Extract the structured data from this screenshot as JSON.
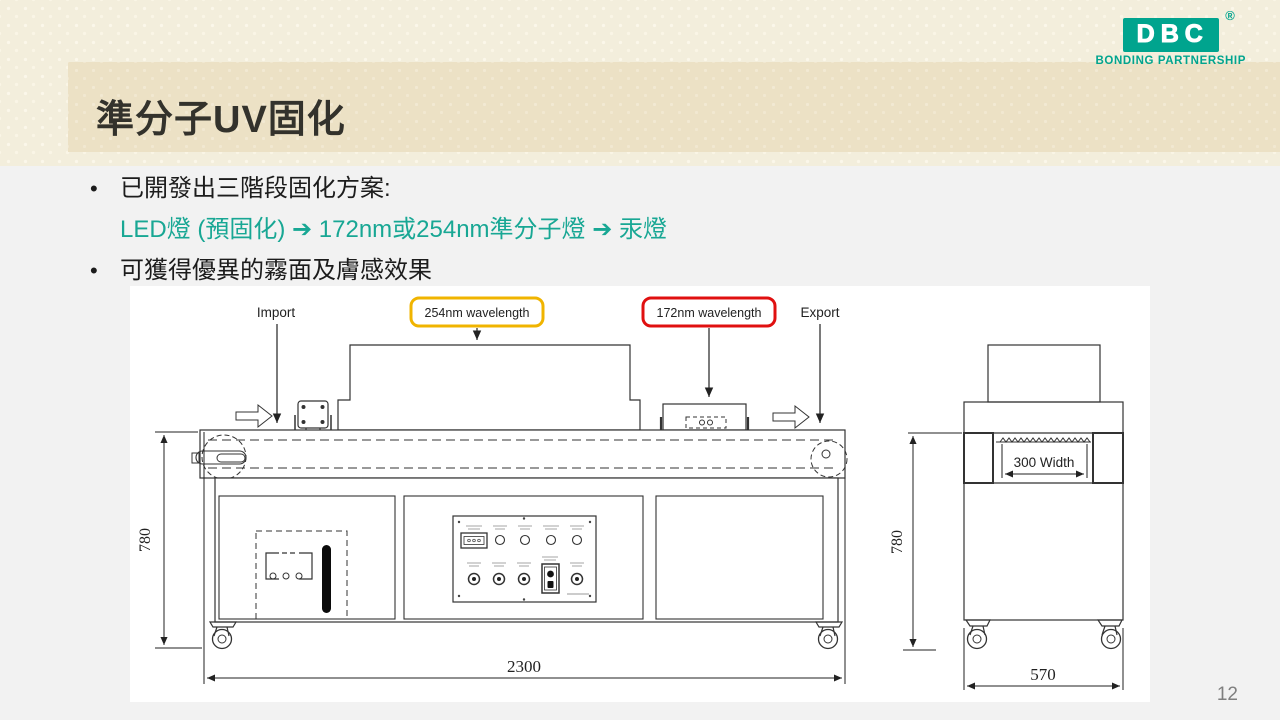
{
  "slide": {
    "title": "準分子UV固化",
    "page_number": "12",
    "bullets": {
      "line1": "已開發出三階段固化方案:",
      "line2": "LED燈 (預固化) ➔ 172nm或254nm準分子燈 ➔ 汞燈",
      "line3": "可獲得優異的霧面及膚感效果"
    },
    "logo": {
      "name": "DBC",
      "tagline": "BONDING PARTNERSHIP",
      "registered_mark": "®",
      "brand_color": "#00a48e"
    },
    "accent_text_color": "#18a794"
  },
  "diagram": {
    "labels": {
      "import": "Import",
      "wavelength_254": "254nm wavelength",
      "wavelength_172": "172nm wavelength",
      "export": "Export"
    },
    "dimensions": {
      "total_width": "2300",
      "machine_height": "780",
      "side_height": "780",
      "side_width": "570",
      "belt_width": "300 Width"
    },
    "highlight_colors": {
      "yellow_box": "#f0b400",
      "red_box": "#e01010"
    }
  }
}
